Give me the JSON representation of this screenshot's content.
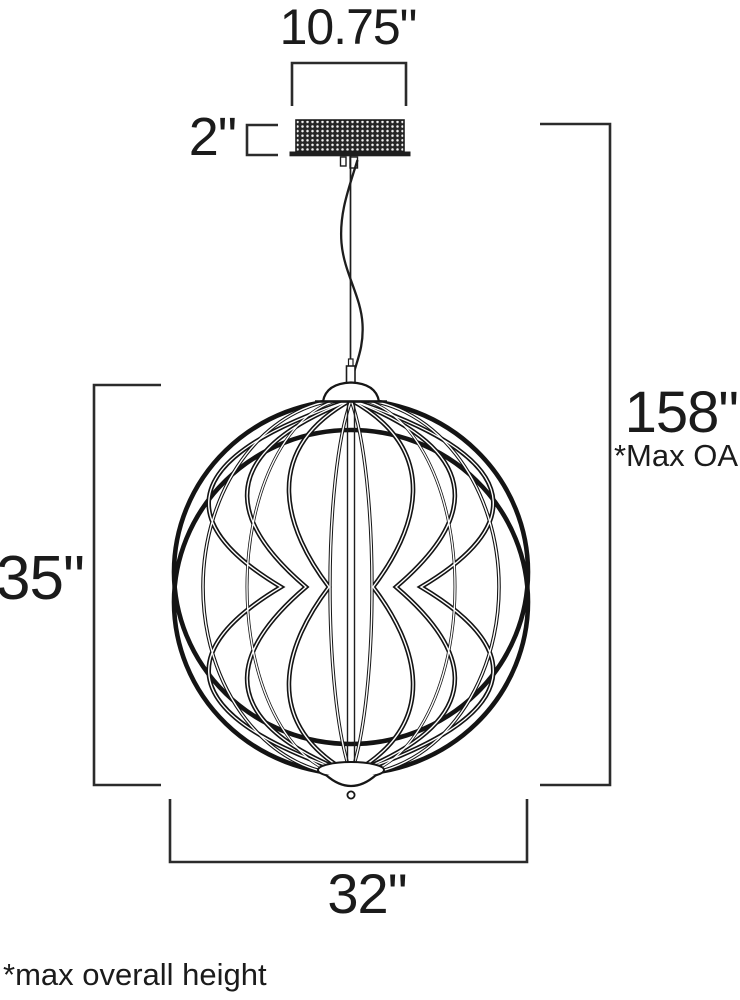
{
  "labels": {
    "canopy_width": "10.75\"",
    "canopy_height": "2\"",
    "max_overall_height": "158\"",
    "max_overall_note": "*Max OA",
    "fixture_height": "35\"",
    "fixture_width": "32\"",
    "footnote": "*max overall height"
  },
  "colors": {
    "background": "#ffffff",
    "line": "#1d1d1d",
    "text": "#1b1b1b"
  }
}
